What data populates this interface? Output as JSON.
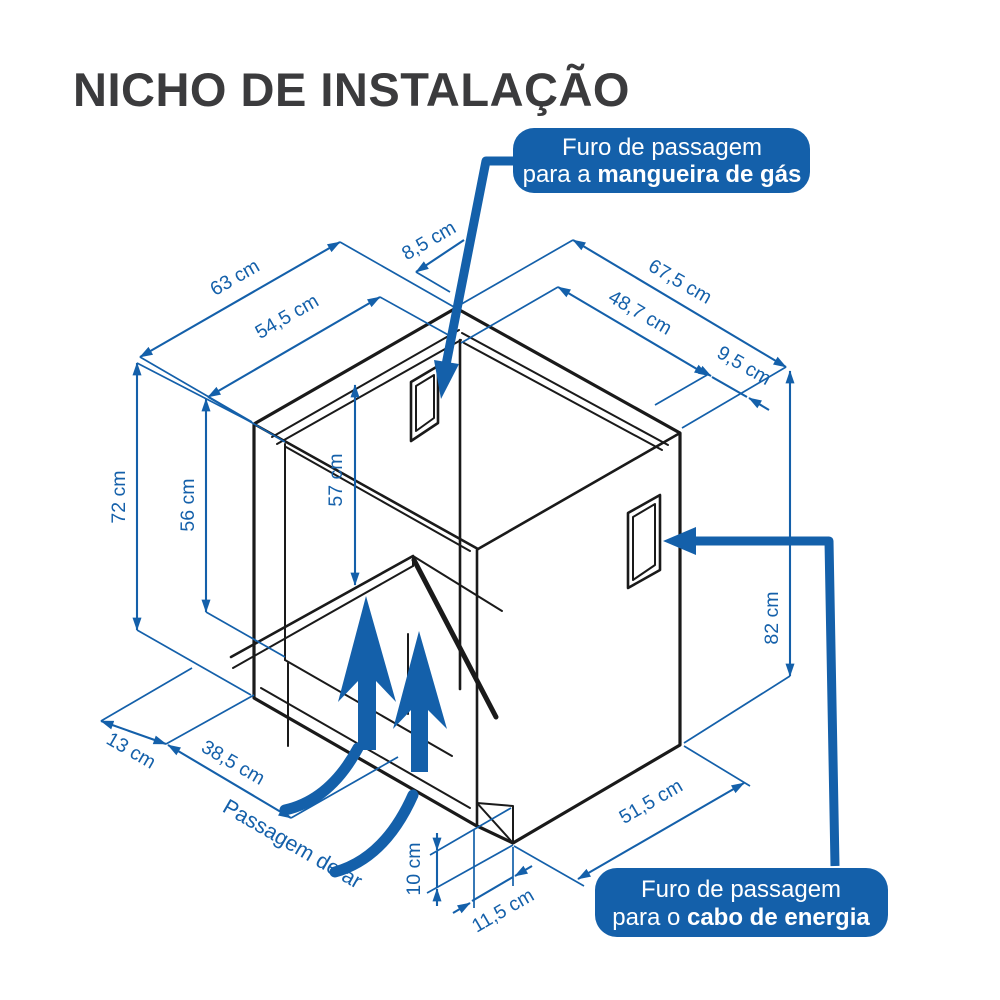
{
  "title": "NICHO DE INSTALAÇÃO",
  "colors": {
    "accent_blue": "#1460AA",
    "line_black": "#1a1a1a",
    "title_gray": "#3b3b3d",
    "background": "#ffffff",
    "callout_text": "#ffffff"
  },
  "callouts": {
    "gas": {
      "line1": "Furo de passagem",
      "line2_prefix": "para a ",
      "line2_bold": "mangueira de gás"
    },
    "power": {
      "line1": "Furo de passagem",
      "line2_prefix": "para o ",
      "line2_bold": "cabo de energia"
    }
  },
  "dims": {
    "outer_width": "63 cm",
    "inner_width": "54,5 cm",
    "back_offset": "8,5 cm",
    "outer_depth": "67,5 cm",
    "inner_depth": "48,7 cm",
    "side_offset": "9,5 cm",
    "outer_height": "72 cm",
    "opening_height": "56 cm",
    "interior_height": "57 cm",
    "side_height": "82 cm",
    "front_gap": "13 cm",
    "air_depth": "38,5 cm",
    "notch_height": "10 cm",
    "notch_width": "11,5 cm",
    "bottom_edge": "51,5 cm",
    "air_label": "Passagem de ar"
  }
}
